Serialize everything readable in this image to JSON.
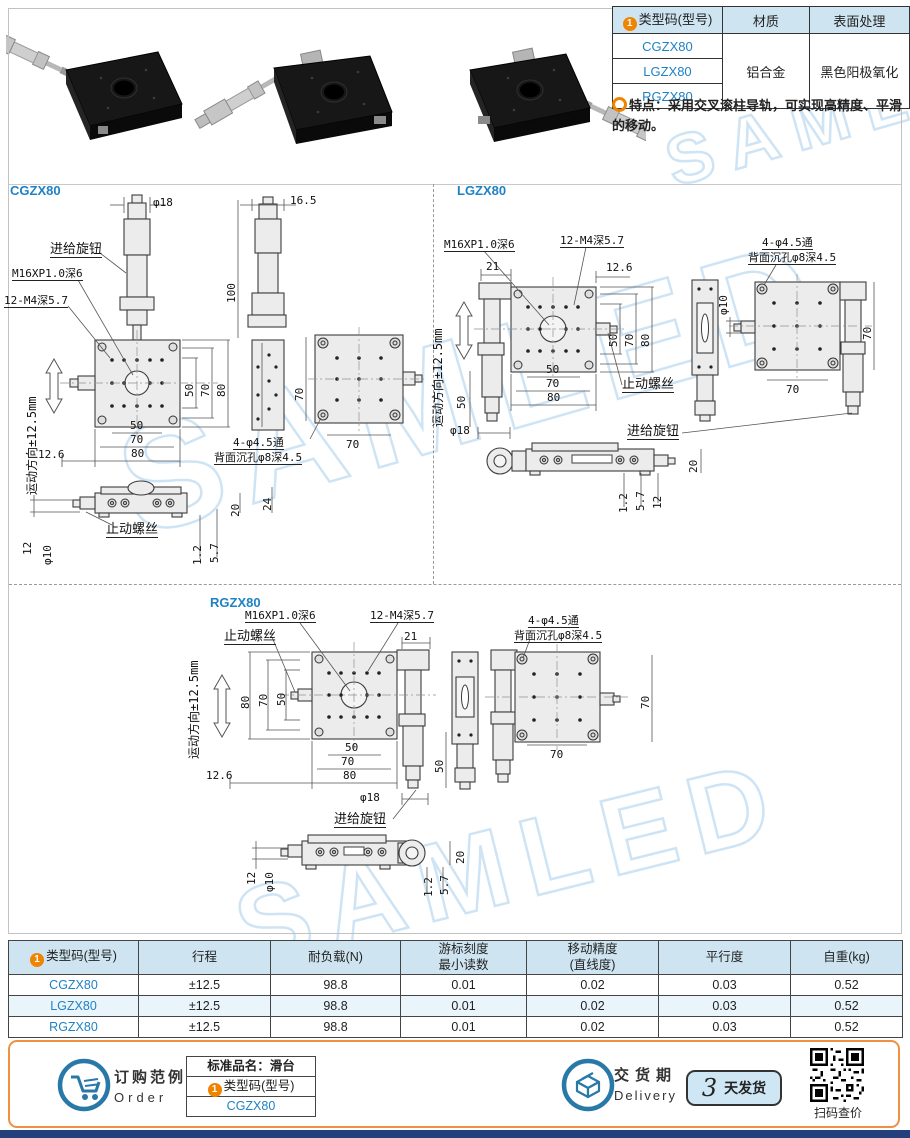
{
  "watermark": "SAMLED",
  "circle_one": "1",
  "info_table": {
    "headers": [
      "类型码(型号)",
      "材质",
      "表面处理"
    ],
    "models": [
      "CGZX80",
      "LGZX80",
      "RGZX80"
    ],
    "material": "铝合金",
    "surface": "黑色阳极氧化"
  },
  "feature_note": "特点：采用交叉滚柱导轨，可实现高精度、平滑的移动。",
  "sections": {
    "cgzx80": {
      "title": "CGZX80",
      "labels": [
        {
          "t": "φ18",
          "x": 153,
          "y": 22
        },
        {
          "t": "16.5",
          "x": 290,
          "y": 20
        },
        {
          "t": "进给旋钮",
          "x": 50,
          "y": 68,
          "u": 1,
          "s": 13
        },
        {
          "t": "M16XP1.0深6",
          "x": 12,
          "y": 93,
          "u": 1
        },
        {
          "t": "12-M4深5.7",
          "x": 4,
          "y": 120,
          "u": 1
        },
        {
          "t": "运动方向±12.5mm",
          "x": 26,
          "y": 320,
          "r": -90,
          "s": 12
        },
        {
          "t": "100",
          "x": 226,
          "y": 128,
          "r": -90
        },
        {
          "t": "50",
          "x": 184,
          "y": 222,
          "r": -90
        },
        {
          "t": "70",
          "x": 200,
          "y": 222,
          "r": -90
        },
        {
          "t": "80",
          "x": 216,
          "y": 222,
          "r": -90
        },
        {
          "t": "50",
          "x": 130,
          "y": 245
        },
        {
          "t": "70",
          "x": 130,
          "y": 259
        },
        {
          "t": "80",
          "x": 131,
          "y": 273
        },
        {
          "t": "12.6",
          "x": 38,
          "y": 274
        },
        {
          "t": "4-φ4.5通",
          "x": 233,
          "y": 262,
          "u": 1
        },
        {
          "t": "背面沉孔φ8深4.5",
          "x": 214,
          "y": 277,
          "u": 1
        },
        {
          "t": "70",
          "x": 294,
          "y": 226,
          "r": -90
        },
        {
          "t": "70",
          "x": 346,
          "y": 264
        },
        {
          "t": "止动螺丝",
          "x": 106,
          "y": 348,
          "u": 1,
          "s": 13
        },
        {
          "t": "12",
          "x": 22,
          "y": 380,
          "r": -90
        },
        {
          "t": "φ10",
          "x": 42,
          "y": 390,
          "r": -90
        },
        {
          "t": "1.2",
          "x": 192,
          "y": 390,
          "r": -90
        },
        {
          "t": "5.7",
          "x": 209,
          "y": 388,
          "r": -90
        },
        {
          "t": "20",
          "x": 230,
          "y": 342,
          "r": -90
        },
        {
          "t": "24",
          "x": 262,
          "y": 336,
          "r": -90
        }
      ]
    },
    "lgzx80": {
      "title": "LGZX80",
      "labels": [
        {
          "t": "M16XP1.0深6",
          "x": 20,
          "y": 64,
          "u": 1
        },
        {
          "t": "12-M4深5.7",
          "x": 136,
          "y": 60,
          "u": 1
        },
        {
          "t": "21",
          "x": 62,
          "y": 86
        },
        {
          "t": "12.6",
          "x": 182,
          "y": 87
        },
        {
          "t": "运动方向±12.5mm",
          "x": 8,
          "y": 252,
          "r": -90,
          "s": 12
        },
        {
          "t": "50",
          "x": 184,
          "y": 172,
          "r": -90
        },
        {
          "t": "70",
          "x": 200,
          "y": 172,
          "r": -90
        },
        {
          "t": "80",
          "x": 216,
          "y": 172,
          "r": -90
        },
        {
          "t": "50",
          "x": 122,
          "y": 189
        },
        {
          "t": "70",
          "x": 122,
          "y": 203
        },
        {
          "t": "80",
          "x": 123,
          "y": 217
        },
        {
          "t": "止动螺丝",
          "x": 198,
          "y": 203,
          "u": 1,
          "s": 13
        },
        {
          "t": "进给旋钮",
          "x": 203,
          "y": 250,
          "u": 1,
          "s": 13
        },
        {
          "t": "50",
          "x": 32,
          "y": 234,
          "r": -90
        },
        {
          "t": "φ18",
          "x": 26,
          "y": 250
        },
        {
          "t": "φ10",
          "x": 294,
          "y": 140,
          "r": -90
        },
        {
          "t": "4-φ4.5通",
          "x": 338,
          "y": 62,
          "u": 1
        },
        {
          "t": "背面沉孔φ8深4.5",
          "x": 324,
          "y": 77,
          "u": 1
        },
        {
          "t": "70",
          "x": 438,
          "y": 165,
          "r": -90
        },
        {
          "t": "70",
          "x": 362,
          "y": 209
        },
        {
          "t": "20",
          "x": 264,
          "y": 298,
          "r": -90
        },
        {
          "t": "1.2",
          "x": 194,
          "y": 338,
          "r": -90
        },
        {
          "t": "5.7",
          "x": 211,
          "y": 336,
          "r": -90
        },
        {
          "t": "12",
          "x": 228,
          "y": 334,
          "r": -90
        }
      ]
    },
    "rgzx80": {
      "title": "RGZX80",
      "labels": [
        {
          "t": "M16XP1.0深6",
          "x": 245,
          "y": 23,
          "u": 1
        },
        {
          "t": "12-M4深5.7",
          "x": 370,
          "y": 23,
          "u": 1
        },
        {
          "t": "止动螺丝",
          "x": 224,
          "y": 43,
          "u": 1,
          "s": 13
        },
        {
          "t": "21",
          "x": 404,
          "y": 44
        },
        {
          "t": "运动方向±12.5mm",
          "x": 188,
          "y": 172,
          "r": -90,
          "s": 12
        },
        {
          "t": "80",
          "x": 240,
          "y": 122,
          "r": -90
        },
        {
          "t": "70",
          "x": 258,
          "y": 120,
          "r": -90
        },
        {
          "t": "50",
          "x": 276,
          "y": 119,
          "r": -90
        },
        {
          "t": "50",
          "x": 345,
          "y": 155
        },
        {
          "t": "70",
          "x": 341,
          "y": 169
        },
        {
          "t": "80",
          "x": 343,
          "y": 183
        },
        {
          "t": "12.6",
          "x": 206,
          "y": 183
        },
        {
          "t": "50",
          "x": 434,
          "y": 186,
          "r": -90
        },
        {
          "t": "φ18",
          "x": 360,
          "y": 205
        },
        {
          "t": "进给旋钮",
          "x": 334,
          "y": 226,
          "u": 1,
          "s": 13
        },
        {
          "t": "4-φ4.5通",
          "x": 528,
          "y": 28,
          "u": 1
        },
        {
          "t": "背面沉孔φ8深4.5",
          "x": 514,
          "y": 43,
          "u": 1
        },
        {
          "t": "70",
          "x": 640,
          "y": 122,
          "r": -90
        },
        {
          "t": "70",
          "x": 550,
          "y": 162
        },
        {
          "t": "12",
          "x": 246,
          "y": 298,
          "r": -90
        },
        {
          "t": "φ10",
          "x": 264,
          "y": 305,
          "r": -90
        },
        {
          "t": "1.2",
          "x": 423,
          "y": 310,
          "r": -90
        },
        {
          "t": "5.7",
          "x": 439,
          "y": 308,
          "r": -90
        },
        {
          "t": "20",
          "x": 455,
          "y": 277,
          "r": -90
        }
      ]
    }
  },
  "spec_table": {
    "headers": [
      {
        "l1": "类型码(型号)"
      },
      {
        "l1": "行程"
      },
      {
        "l1": "耐负载(N)"
      },
      {
        "l1": "游标刻度",
        "l2": "最小读数"
      },
      {
        "l1": "移动精度",
        "l2": "(直线度)"
      },
      {
        "l1": "平行度"
      },
      {
        "l1": "自重(kg)"
      }
    ],
    "rows": [
      [
        "CGZX80",
        "±12.5",
        "98.8",
        "0.01",
        "0.02",
        "0.03",
        "0.52"
      ],
      [
        "LGZX80",
        "±12.5",
        "98.8",
        "0.01",
        "0.02",
        "0.03",
        "0.52"
      ],
      [
        "RGZX80",
        "±12.5",
        "98.8",
        "0.01",
        "0.02",
        "0.03",
        "0.52"
      ]
    ]
  },
  "footer": {
    "order_label": "订购范例",
    "order_en": "Order",
    "order_box": {
      "line1": "标准品名：滑台",
      "line2": "类型码(型号)",
      "line3": "CGZX80"
    },
    "delivery_label": "交货期",
    "delivery_en": "Delivery",
    "delivery_days": "3",
    "delivery_unit": "天发货",
    "qr_caption": "扫码查价"
  }
}
